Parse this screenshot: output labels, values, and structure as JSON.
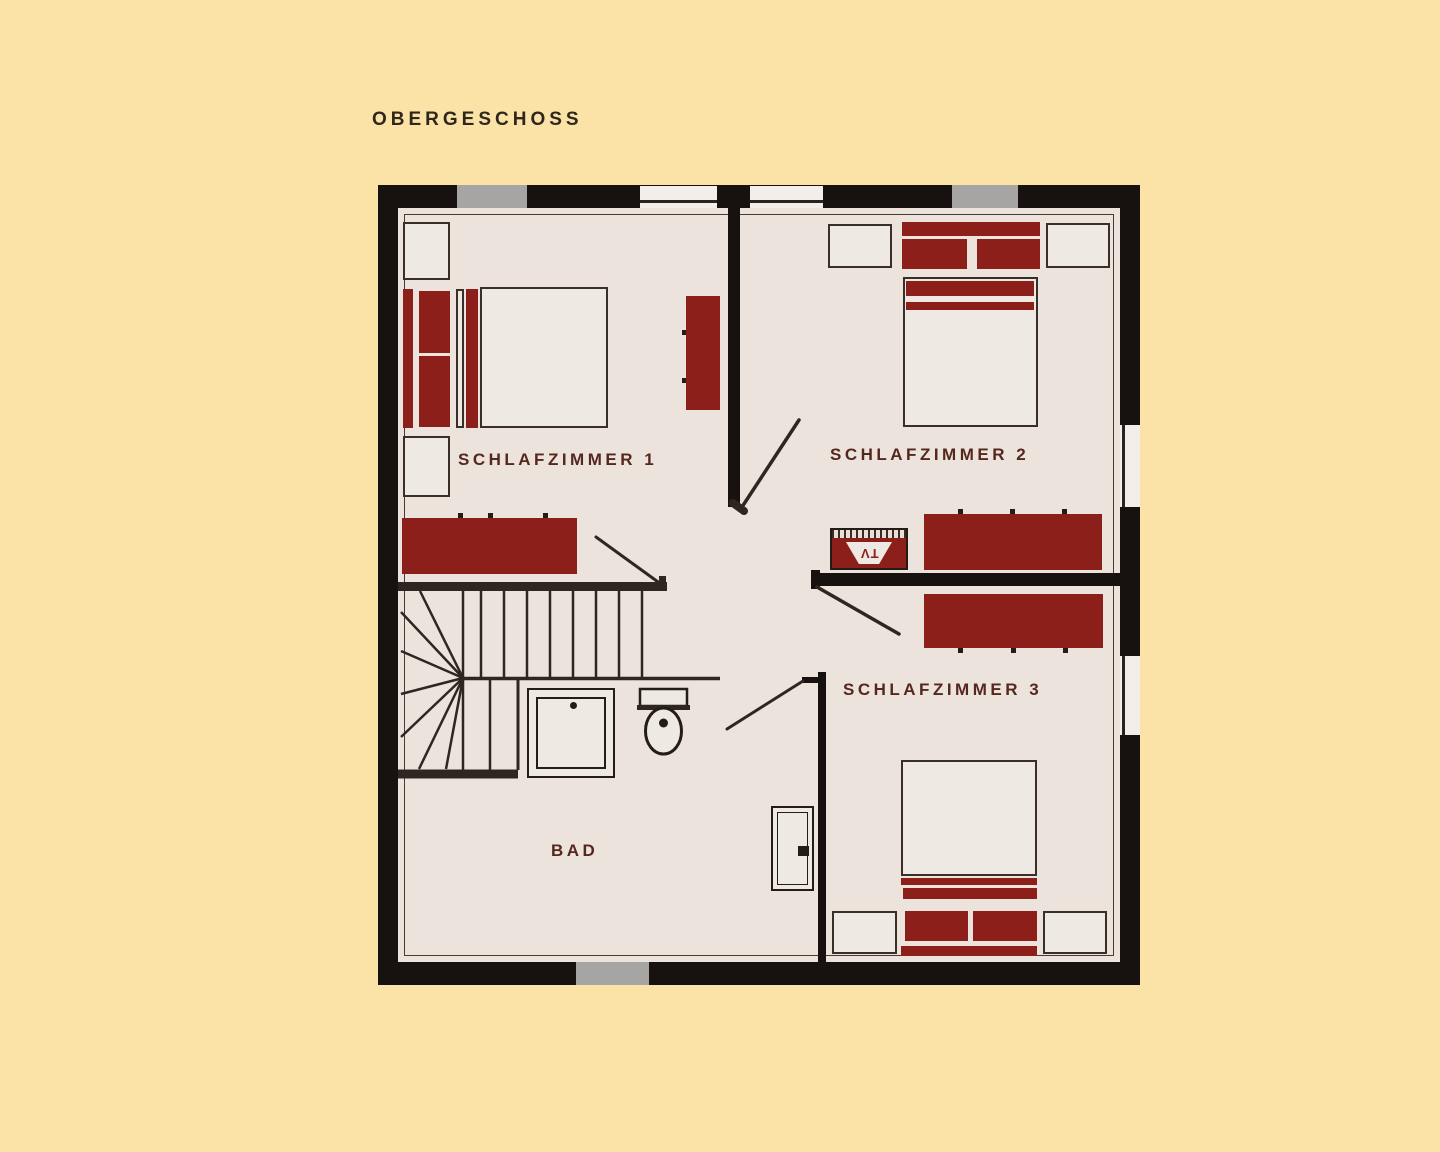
{
  "page": {
    "title": "OBERGESCHOSS"
  },
  "rooms": [
    {
      "id": "schlafzimmer-1",
      "label": "SCHLAFZIMMER 1"
    },
    {
      "id": "schlafzimmer-2",
      "label": "SCHLAFZIMMER 2"
    },
    {
      "id": "schlafzimmer-3",
      "label": "SCHLAFZIMMER 3"
    },
    {
      "id": "bad",
      "label": "BAD"
    }
  ],
  "tv": {
    "label": "TV"
  },
  "colors": {
    "background": "#fbe2a6",
    "floor": "#ece3dd",
    "fill_light": "#efe9e3",
    "window_white": "#f3eee9",
    "wall": "#171210",
    "furniture_red": "#8d1f1b",
    "window_gray": "#a6a5a3",
    "label_maroon": "#55281e",
    "title_brown": "#2f261c",
    "line_dark": "#2e2721"
  }
}
